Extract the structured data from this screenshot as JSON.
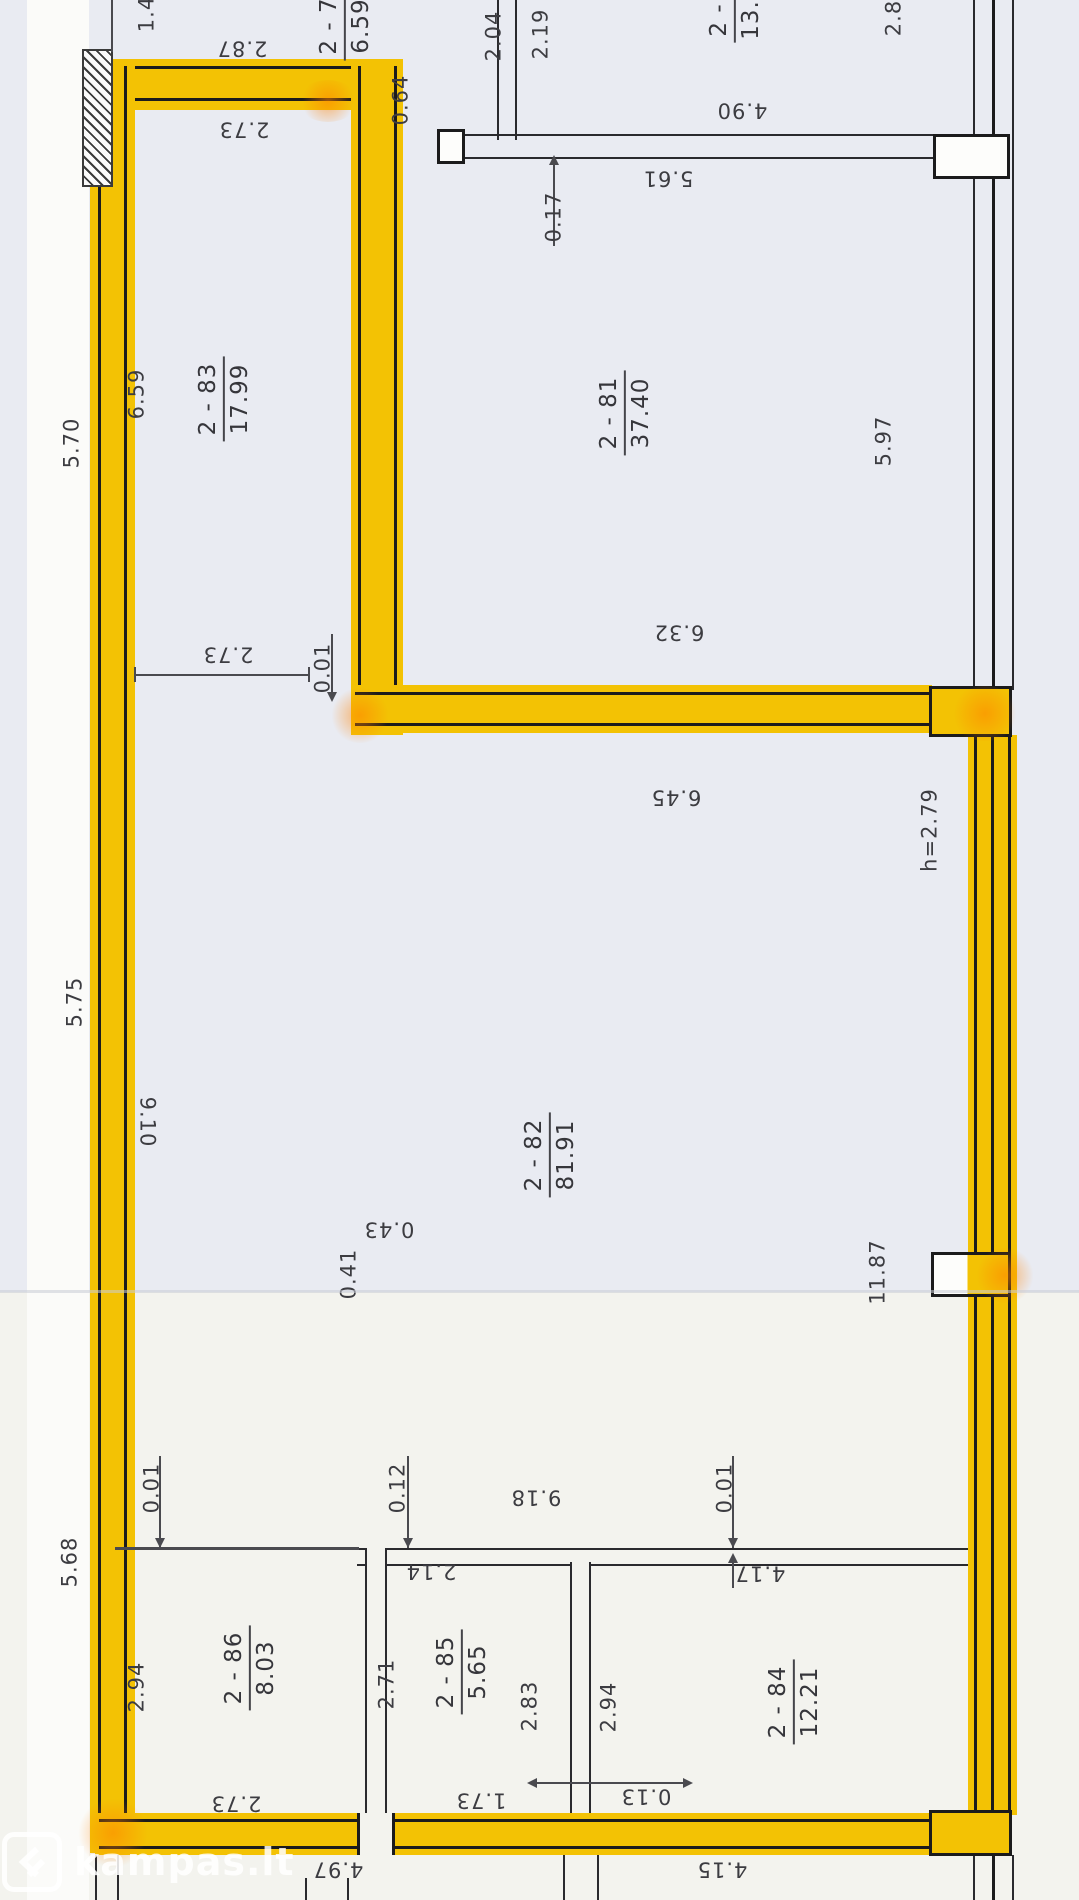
{
  "watermark": {
    "text": "kampas.lt"
  },
  "rooms": {
    "r83": {
      "number": "2 - 83",
      "area": "17.99"
    },
    "r81": {
      "number": "2 - 81",
      "area": "37.40"
    },
    "r82": {
      "number": "2 - 82",
      "area": "81.91"
    },
    "r84": {
      "number": "2 - 84",
      "area": "12.21"
    },
    "r85": {
      "number": "2 - 85",
      "area": "5.65"
    },
    "r86": {
      "number": "2 - 86",
      "area": "8.03"
    },
    "r_top_small": {
      "number": "2 - 7",
      "area": "6.59"
    },
    "r_top_right": {
      "number": "2 -",
      "area": "13."
    }
  },
  "dims": {
    "d1_4": "1.4",
    "d2_87": "2.87",
    "d2_73a": "2.73",
    "d0_64": "0.64",
    "d2_04": "2.04",
    "d2_19": "2.19",
    "d0_17": "0.17",
    "d5_61": "5.61",
    "d4_90": "4.90",
    "d2_8": "2.8",
    "d5_70": "5.70",
    "d6_59": "6.59",
    "d5_97": "5.97",
    "d0_01a": "0.01",
    "d2_73b": "2.73",
    "d6_32": "6.32",
    "d6_45": "6.45",
    "dh279": "h=2.79",
    "d5_75": "5.75",
    "d9_10": "9.10",
    "d0_43": "0.43",
    "d0_41": "0.41",
    "d11_87": "11.87",
    "d0_01b": "0.01",
    "d0_12": "0.12",
    "d9_18": "9.18",
    "d0_01c": "0.01",
    "d5_68": "5.68",
    "d2_94a": "2.94",
    "d2_71": "2.71",
    "d2_83w": "2.83",
    "d2_94b": "2.94",
    "d2_14": "2.14",
    "d4_17": "4.17",
    "d1_73": "1.73",
    "d2_73c": "2.73",
    "d0_13": "0.13",
    "d4_97": "4.97",
    "d4_15": "4.15"
  },
  "colors": {
    "highlight": "#f3c204",
    "paper_upper": "#e9ebf2",
    "paper_lower": "#f3f3ee",
    "ink": "#3c3c41",
    "wall_line": "#1b1b1c",
    "watermark": "#ffffff"
  }
}
